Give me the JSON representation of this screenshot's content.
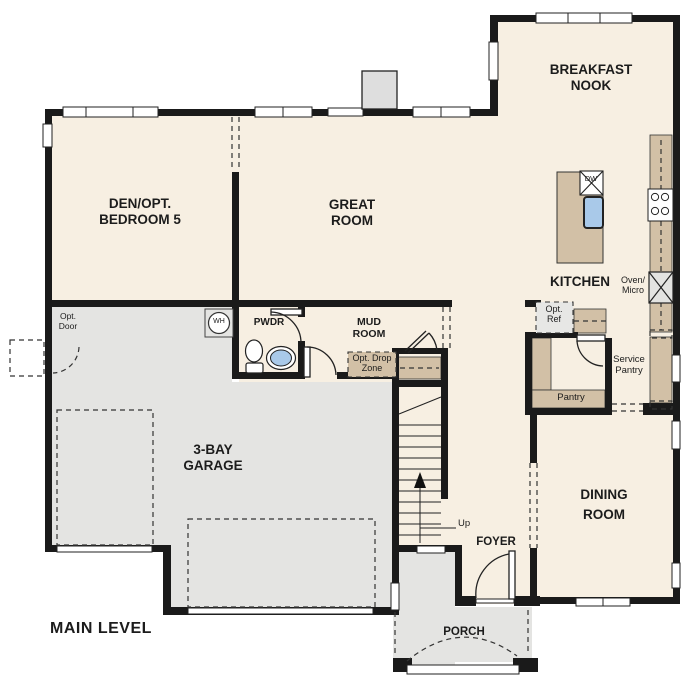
{
  "title": "MAIN LEVEL",
  "rooms": {
    "den": {
      "lines": [
        "DEN/OPT.",
        "BEDROOM 5"
      ]
    },
    "great_room": {
      "lines": [
        "GREAT",
        "ROOM"
      ]
    },
    "breakfast_nook": {
      "lines": [
        "BREAKFAST",
        "NOOK"
      ]
    },
    "kitchen": {
      "label": "KITCHEN"
    },
    "dining_room": {
      "lines": [
        "DINING",
        "ROOM"
      ]
    },
    "garage": {
      "lines": [
        "3-BAY",
        "GARAGE"
      ]
    },
    "mud_room": {
      "lines": [
        "MUD",
        "ROOM"
      ]
    },
    "powder": {
      "label": "PWDR"
    },
    "foyer": {
      "label": "FOYER"
    },
    "porch": {
      "label": "PORCH"
    },
    "pantry": {
      "label": "Pantry"
    },
    "service_pantry": {
      "lines": [
        "Service",
        "Pantry"
      ]
    }
  },
  "annotations": {
    "opt_door": {
      "lines": [
        "Opt.",
        "Door"
      ]
    },
    "opt_ref": {
      "lines": [
        "Opt.",
        "Ref"
      ]
    },
    "opt_drop_zone": {
      "lines": [
        "Opt. Drop",
        "Zone"
      ]
    },
    "oven_micro": {
      "lines": [
        "Oven/",
        "Micro"
      ]
    },
    "dishwasher": "DW",
    "water_heater": "WH",
    "stairs_up": "Up"
  },
  "colors": {
    "room_fill": "#f7efe2",
    "garage_fill": "#e4e4e2",
    "counter_fill": "#d2c0a6",
    "wall": "#1a1a1a",
    "sink_blue": "#a9c9e9",
    "appliance_gray": "#e0e0de"
  }
}
